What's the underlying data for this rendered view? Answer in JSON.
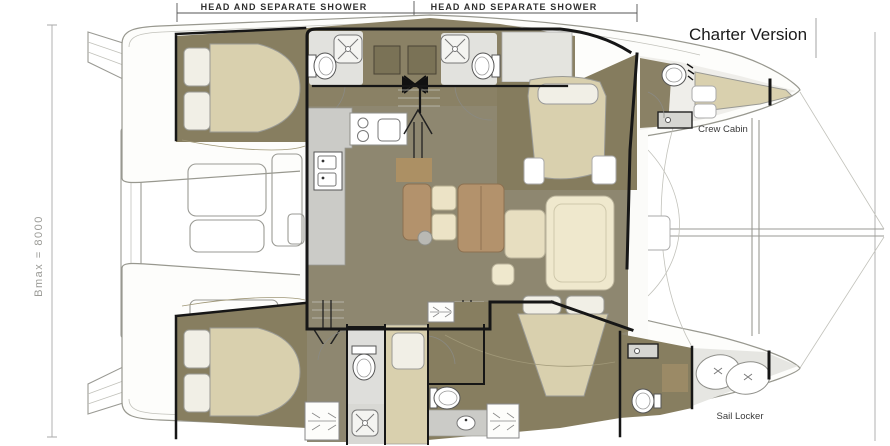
{
  "labels": {
    "head_shower_left": "HEAD AND SEPARATE SHOWER",
    "head_shower_right": "HEAD AND SEPARATE SHOWER",
    "version": "Charter Version",
    "crew_cabin": "Crew Cabin",
    "sail_locker": "Sail Locker",
    "beam_dimension": "Bmax = 8000"
  },
  "colors": {
    "cabin_floor": "#877E60",
    "salon_floor": "#8E8770",
    "bed_beige": "#D9D0AE",
    "pillow_white": "#F1EFE6",
    "furniture_brown": "#B3926C",
    "furniture_cream": "#EFE8CD",
    "counter_gray": "#CBCBC7",
    "head_floor": "#E2E2DE",
    "wall_black": "#161616",
    "hull_outline": "#9A9A94"
  }
}
